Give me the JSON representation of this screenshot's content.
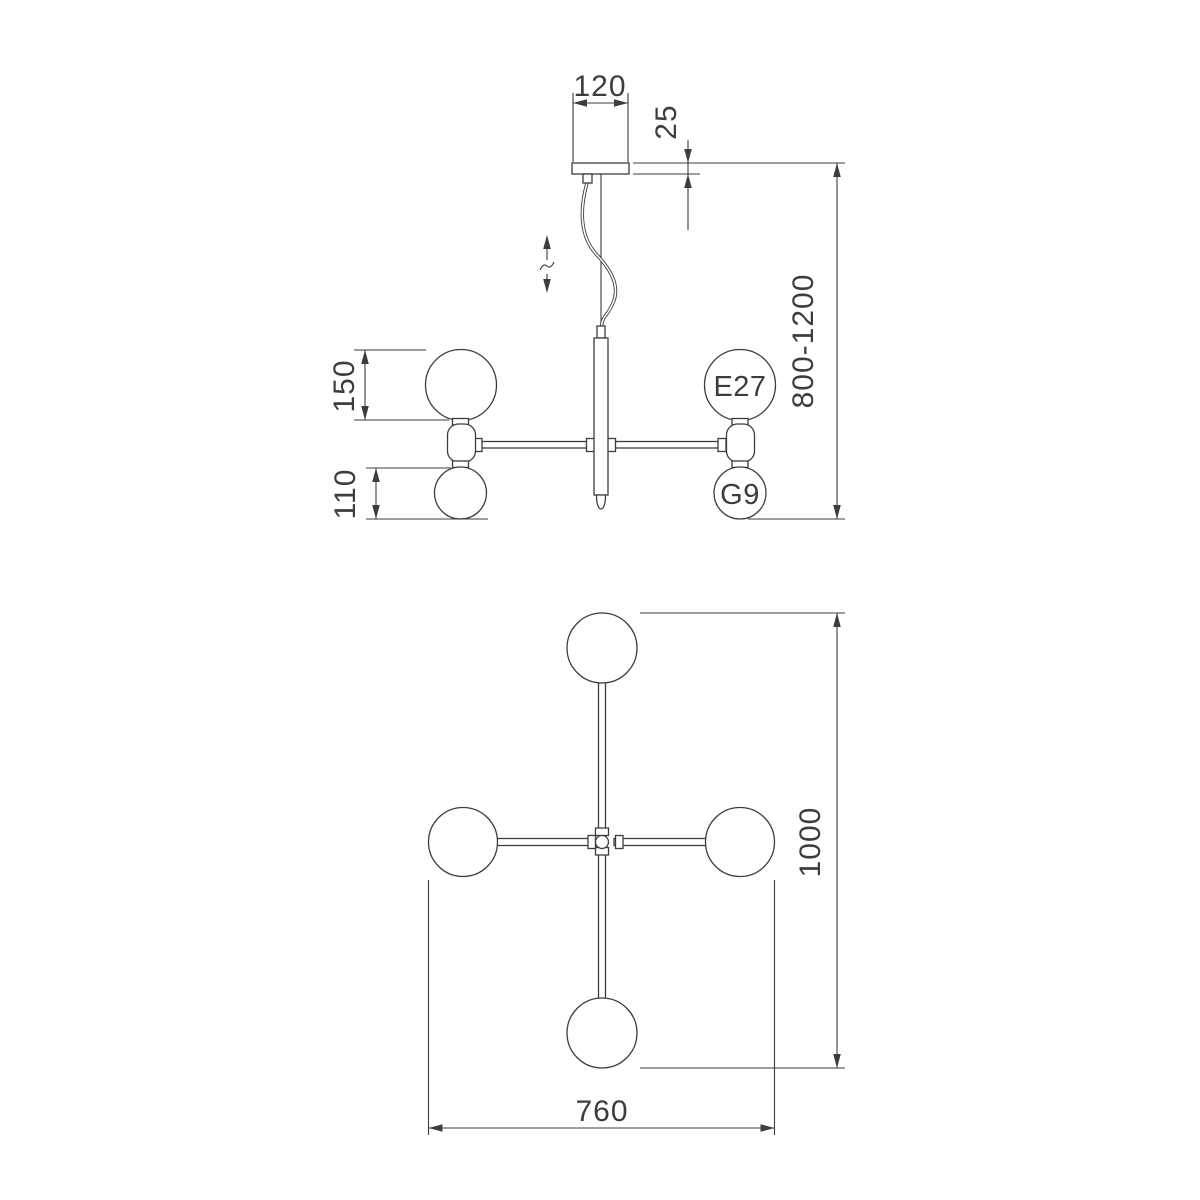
{
  "colors": {
    "line": "#3d3d3d",
    "background": "#ffffff"
  },
  "side_view": {
    "canopy_width_mm": "120",
    "canopy_drop_mm": "25",
    "suspension_height_range_mm": "800-1200",
    "large_globe_diameter_mm": "150",
    "small_globe_diameter_mm": "110",
    "large_socket_label": "E27",
    "small_socket_label": "G9"
  },
  "plan_view": {
    "overall_length_mm": "1000",
    "overall_width_mm": "760"
  }
}
